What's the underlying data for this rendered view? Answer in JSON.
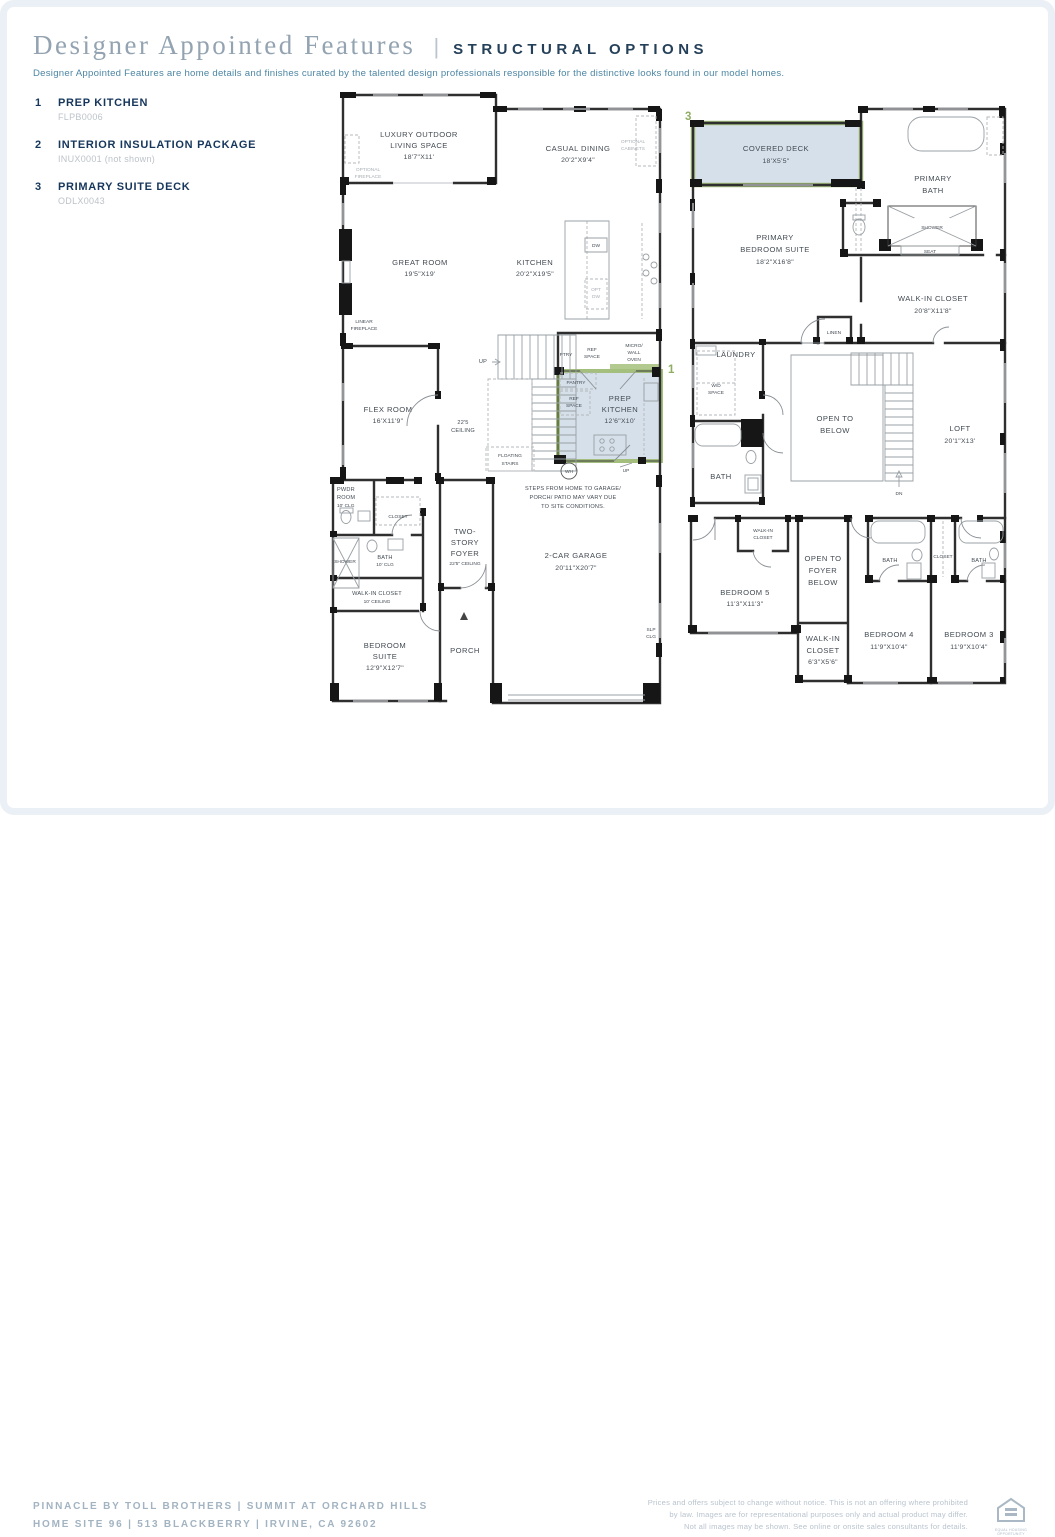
{
  "header": {
    "title": "Designer Appointed Features",
    "divider": "|",
    "tag": "STRUCTURAL OPTIONS",
    "description": "Designer Appointed Features are home details and finishes curated by the talented design professionals responsible for the distinctive looks found in our model homes."
  },
  "legend": {
    "items": [
      {
        "num": "1",
        "title": "PREP KITCHEN",
        "code": "FLPB0006"
      },
      {
        "num": "2",
        "title": "INTERIOR INSULATION PACKAGE",
        "code": "INUX0001 (not shown)"
      },
      {
        "num": "3",
        "title": "PRIMARY SUITE DECK",
        "code": "ODLX0043"
      }
    ]
  },
  "colors": {
    "accent_navy": "#16365c",
    "title_gray_blue": "#93a3b1",
    "description_teal": "#4c86a4",
    "highlight_fill": "#d6e0ea",
    "highlight_border": "#a4bf7d",
    "marker_green": "#8fae62",
    "code_gray": "#bcc3c9"
  },
  "f1": {
    "marker": "1",
    "outdoor1": "LUXURY OUTDOOR",
    "outdoor2": "LIVING SPACE",
    "outdoor3": "18'7\"X11'",
    "optfire1": "OPTIONAL",
    "optfire2": "FIREPLACE",
    "dining1": "CASUAL DINING",
    "dining2": "20'2\"X9'4\"",
    "optcab1": "OPTIONAL",
    "optcab2": "CABINETS",
    "great1": "GREAT ROOM",
    "great2": "19'5\"X19'",
    "kitchen1": "KITCHEN",
    "kitchen2": "20'2\"X19'5\"",
    "dw": "DW",
    "optdw1": "OPT",
    "optdw2": "DW",
    "linfire1": "LINEAR",
    "linfire2": "FIREPLACE",
    "flex1": "FLEX ROOM",
    "flex2": "16'X11'9\"",
    "ceil1": "22'5",
    "ceil2": "CEILING",
    "up1": "UP",
    "up2": "UP",
    "ptry": "PTRY",
    "reftop1": "REF",
    "reftop2": "SPACE",
    "micro1": "MICRO/",
    "micro2": "WALL",
    "micro3": "OVEN",
    "pantry": "PANTRY",
    "ref1": "REF",
    "ref2": "SPACE",
    "prep1": "PREP",
    "prep2": "KITCHEN",
    "prep3": "12'6\"X10'",
    "float1": "FLOATING",
    "float2": "STAIRS",
    "wh": "WH",
    "pwdr1": "PWDR",
    "pwdr2": "ROOM",
    "pwdr3": "10' CLG",
    "closet": "CLOSET",
    "shower": "SHOWER",
    "bath1": "BATH",
    "bath2": "10' CLG",
    "wic1": "WALK-IN CLOSET",
    "wic2": "10' CEILING",
    "bed1": "BEDROOM",
    "bed2": "SUITE",
    "bed3": "12'9\"X12'7\"",
    "foyer1": "TWO-",
    "foyer2": "STORY",
    "foyer3": "FOYER",
    "foyer4": "22'5\" CEILING",
    "porch": "PORCH",
    "garage1": "2-CAR GARAGE",
    "garage2": "20'11\"X20'7\"",
    "slp1": "SLP",
    "slp2": "CLG",
    "note1": "STEPS FROM HOME TO GARAGE/",
    "note2": "PORCH/ PATIO MAY VARY DUE",
    "note3": "TO SITE CONDITIONS."
  },
  "f2": {
    "marker": "3",
    "deck1": "COVERED DECK",
    "deck2": "18'X5'5\"",
    "pbath1": "PRIMARY",
    "pbath2": "BATH",
    "shower": "SHOWER",
    "seat": "SEAT",
    "pbed1": "PRIMARY",
    "pbed2": "BEDROOM SUITE",
    "pbed3": "18'2\"X16'8\"",
    "wic1": "WALK-IN CLOSET",
    "wic2": "20'8\"X11'8\"",
    "linen": "LINEN",
    "laundry": "LAUNDRY",
    "wd1": "W/D",
    "wd2": "SPACE",
    "bathL": "BATH",
    "open1": "OPEN TO",
    "open2": "BELOW",
    "loft1": "LOFT",
    "loft2": "20'1\"X13'",
    "dn": "DN",
    "wics1": "WALK-IN",
    "wics2": "CLOSET",
    "openf1": "OPEN TO",
    "openf2": "FOYER",
    "openf3": "BELOW",
    "bed5a": "BEDROOM 5",
    "bed5b": "11'3\"X11'3\"",
    "wic5a": "WALK-IN",
    "wic5b": "CLOSET",
    "wic5c": "6'3\"X5'6\"",
    "bath4": "BATH",
    "closet": "CLOSET",
    "bath3": "BATH",
    "bed4a": "BEDROOM 4",
    "bed4b": "11'9\"X10'4\"",
    "bed3a": "BEDROOM 3",
    "bed3b": "11'9\"X10'4\""
  },
  "footer": {
    "line1": "PINNACLE BY TOLL BROTHERS | SUMMIT AT ORCHARD HILLS",
    "line2": "HOME SITE 96 | 513 BLACKBERRY | IRVINE, CA 92602",
    "legal1": "Prices and offers subject to change without notice. This is not an offering where prohibited",
    "legal2": "by law. Images are for representational purposes only and actual product may differ.",
    "legal3": "Not all images may be shown. See online or onsite sales consultants for details.",
    "eho1": "EQUAL HOUSING",
    "eho2": "OPPORTUNITY"
  }
}
